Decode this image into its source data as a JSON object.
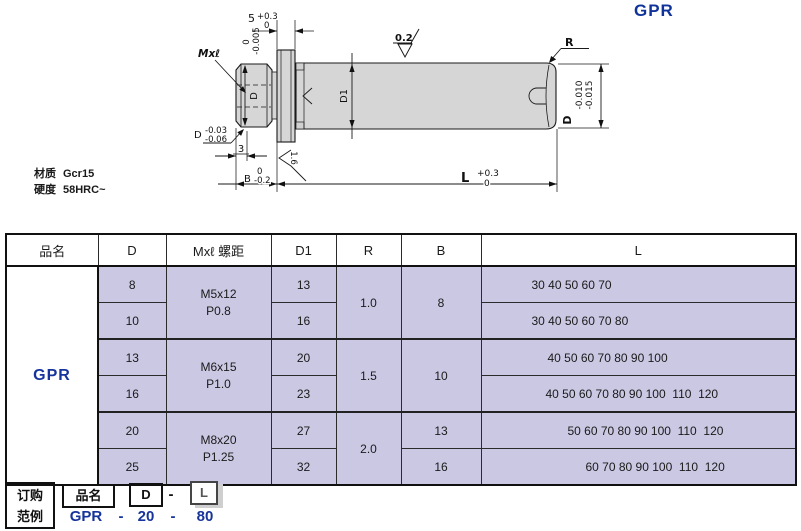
{
  "title": "GPR",
  "drawing": {
    "thread_label": "Mxℓ",
    "dim5": {
      "value": "5",
      "upper": "+0.3",
      "lower": "0"
    },
    "collar_tol": {
      "upper": "0",
      "lower": "-0.005"
    },
    "finish_top": "0.2",
    "radius_label": "R",
    "d_right": {
      "label": "D",
      "upper": "-0.010",
      "lower": "-0.015"
    },
    "d1_label": "D1",
    "d_thread_label": "D",
    "d_left": {
      "label": "D",
      "upper": "-0.03",
      "lower": "-0.06"
    },
    "dim3": "3",
    "dimB": {
      "label": "B",
      "upper": "0",
      "lower": "-0.2"
    },
    "dimL": {
      "label": "L",
      "upper": "+0.3",
      "lower": "0"
    },
    "finish_face": "1.6",
    "material_label": "材质",
    "material_value": "Gcr15",
    "hardness_label": "硬度",
    "hardness_value": "58HRC~"
  },
  "table": {
    "headers": [
      "品名",
      "D",
      "Mxℓ 螺距",
      "D1",
      "R",
      "B",
      "L"
    ],
    "product": "GPR",
    "d": [
      "8",
      "10",
      "13",
      "16",
      "20",
      "25"
    ],
    "thread": [
      {
        "size": "M5x12",
        "pitch": "P0.8"
      },
      {
        "size": "M6x15",
        "pitch": "P1.0"
      },
      {
        "size": "M8x20",
        "pitch": "P1.25"
      }
    ],
    "d1": [
      "13",
      "16",
      "20",
      "23",
      "27",
      "32"
    ],
    "r": [
      "1.0",
      "1.5",
      "2.0"
    ],
    "b": [
      "8",
      "10",
      "13",
      "16"
    ],
    "l": [
      "30 40 50 60 70",
      "30 40 50 60 70 80",
      "40 50 60 70 80 90 100",
      "40 50 60 70 80 90 100  110  120",
      "50 60 70 80 90 100  110  120",
      "60 70 80 90 100  110  120"
    ]
  },
  "order": {
    "box_line1": "订购",
    "box_line2": "范例",
    "part_label": "品名",
    "d_label": "D",
    "dash": "-",
    "l_label": "L",
    "example": {
      "name": "GPR",
      "dash1": "-",
      "d": "20",
      "dash2": "-",
      "l": "80"
    }
  },
  "colors": {
    "accent_blue": "#16349b",
    "cell_lavender": "#cbc8e3",
    "part_grey": "#d6d6d6"
  }
}
